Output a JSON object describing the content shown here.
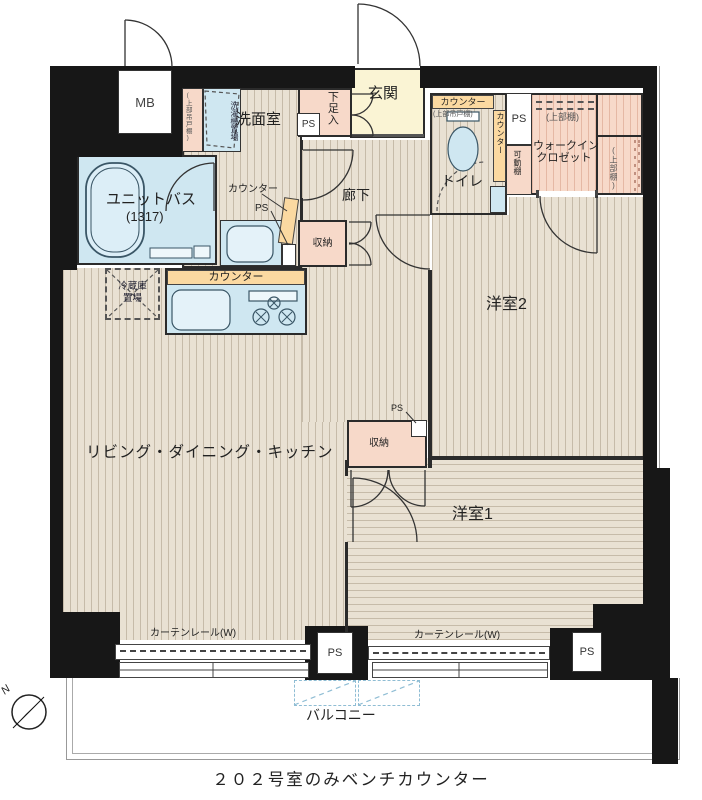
{
  "caption": "２０２号室のみベンチカウンター",
  "compass": {
    "north": "N"
  },
  "labels": {
    "mb": "MB",
    "genkan": "玄関",
    "shoe_cabinet": "下足入",
    "washroom": "洗面室",
    "washer_col1": "洗濯機",
    "washer_col2": "置場",
    "upper_hanging_cupboard": "(上部吊戸棚)",
    "unit_bath": "ユニットバス",
    "unit_bath_size": "(1317)",
    "counter": "カウンター",
    "ps": "PS",
    "toilet": "トイレ",
    "movable_shelf": "可動棚",
    "wic_line1": "ウォークイン",
    "wic_line2": "クロゼット",
    "upper_shelf": "(上部棚)",
    "hallway": "廊下",
    "storage": "収納",
    "fridge_line1": "冷蔵庫",
    "fridge_line2": "置場",
    "ldk": "リビング・ダイニング・キッチン",
    "bedroom2": "洋室2",
    "bedroom1": "洋室1",
    "curtain_rail": "カーテンレール(W)",
    "balcony": "バルコニー"
  },
  "colors": {
    "wall": "#171717",
    "floor_beige": "#e9e1d3",
    "room_pink": "#f7d9c9",
    "fixture_blue": "#cfe7f1",
    "counter_orange": "#fbd9a1",
    "entry_yellow": "#faf4d4",
    "balcony_dash_blue": "#8fbdd4"
  }
}
